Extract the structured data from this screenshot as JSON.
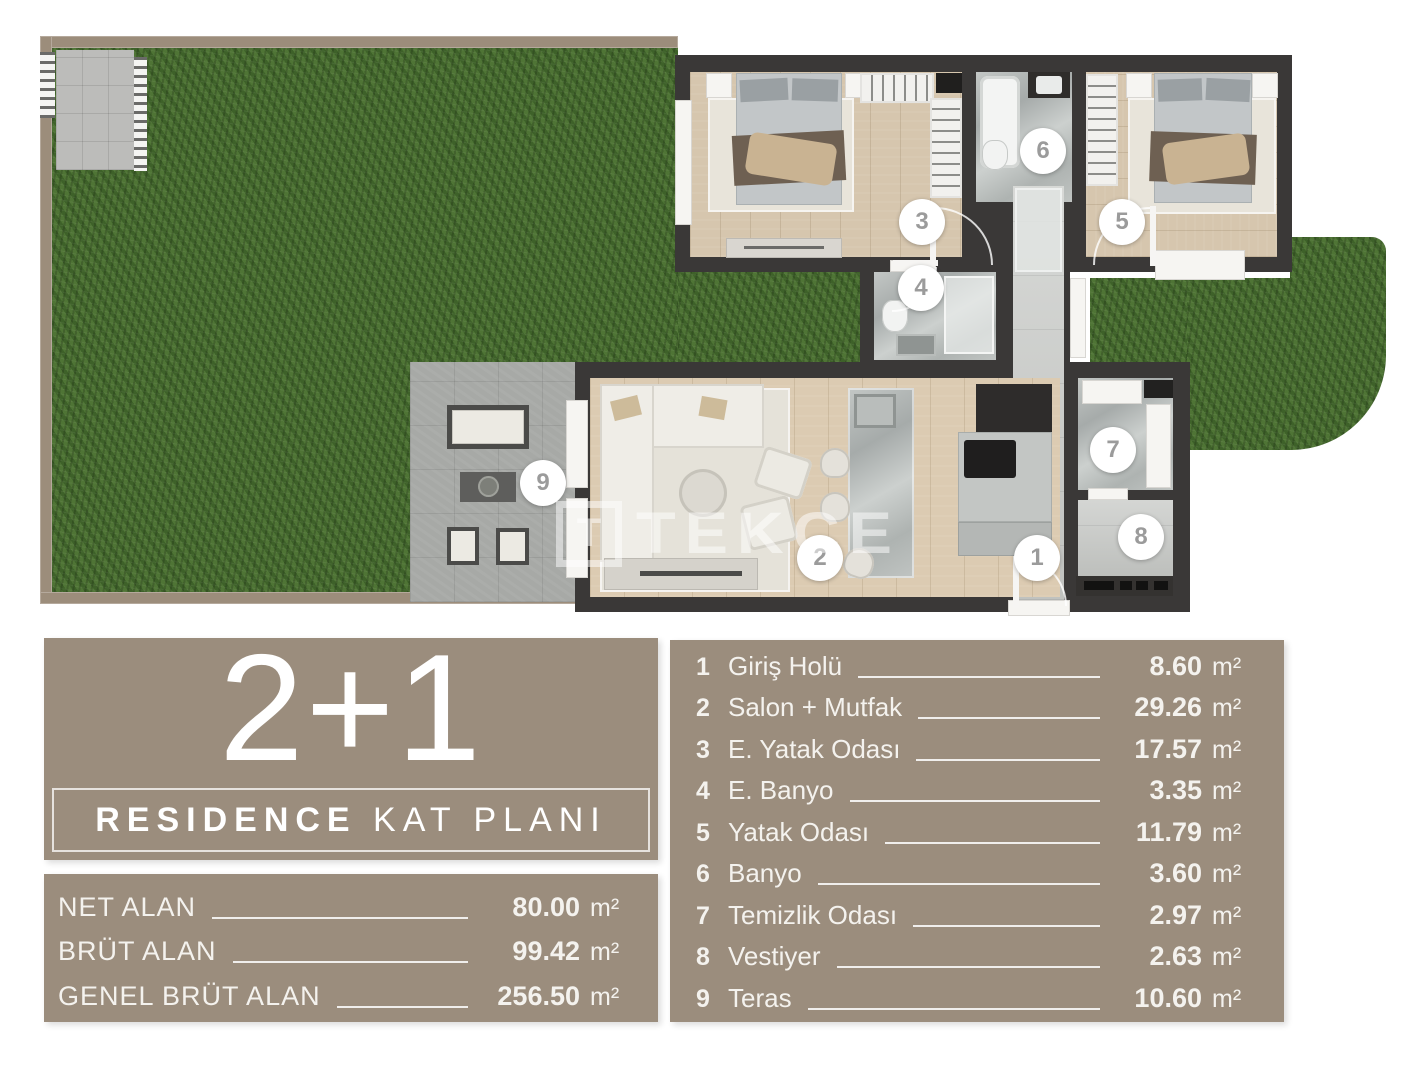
{
  "plan": {
    "watermark": "TEKCE",
    "markers": [
      {
        "n": "1",
        "x": 1037,
        "y": 558
      },
      {
        "n": "2",
        "x": 820,
        "y": 558
      },
      {
        "n": "3",
        "x": 922,
        "y": 222
      },
      {
        "n": "4",
        "x": 921,
        "y": 288
      },
      {
        "n": "5",
        "x": 1122,
        "y": 222
      },
      {
        "n": "6",
        "x": 1043,
        "y": 151
      },
      {
        "n": "7",
        "x": 1113,
        "y": 450
      },
      {
        "n": "8",
        "x": 1141,
        "y": 537
      },
      {
        "n": "9",
        "x": 543,
        "y": 483
      }
    ]
  },
  "panel": {
    "type_label": "2+1",
    "plan_title_bold": "RESIDENCE",
    "plan_title_light": " KAT PLANI"
  },
  "areas": {
    "rows": [
      {
        "label": "NET ALAN",
        "value": "80.00",
        "unit": "m²"
      },
      {
        "label": "BRÜT ALAN",
        "value": "99.42",
        "unit": "m²"
      },
      {
        "label": "GENEL BRÜT ALAN",
        "value": "256.50",
        "unit": "m²"
      }
    ]
  },
  "legend": {
    "rows": [
      {
        "no": "1",
        "name": "Giriş Holü",
        "value": "8.60",
        "unit": "m²"
      },
      {
        "no": "2",
        "name": "Salon + Mutfak",
        "value": "29.26",
        "unit": "m²"
      },
      {
        "no": "3",
        "name": "E. Yatak Odası",
        "value": "17.57",
        "unit": "m²"
      },
      {
        "no": "4",
        "name": "E. Banyo",
        "value": "3.35",
        "unit": "m²"
      },
      {
        "no": "5",
        "name": "Yatak Odası",
        "value": "11.79",
        "unit": "m²"
      },
      {
        "no": "6",
        "name": "Banyo",
        "value": "3.60",
        "unit": "m²"
      },
      {
        "no": "7",
        "name": "Temizlik Odası",
        "value": "2.97",
        "unit": "m²"
      },
      {
        "no": "8",
        "name": "Vestiyer",
        "value": "2.63",
        "unit": "m²"
      },
      {
        "no": "9",
        "name": "Teras",
        "value": "10.60",
        "unit": "m²"
      }
    ]
  },
  "colors": {
    "panel_taupe": "#9b8d7d",
    "wall_dark": "#3a3837",
    "grass_green": "#4c7134",
    "text_light": "#f4f2ee"
  }
}
